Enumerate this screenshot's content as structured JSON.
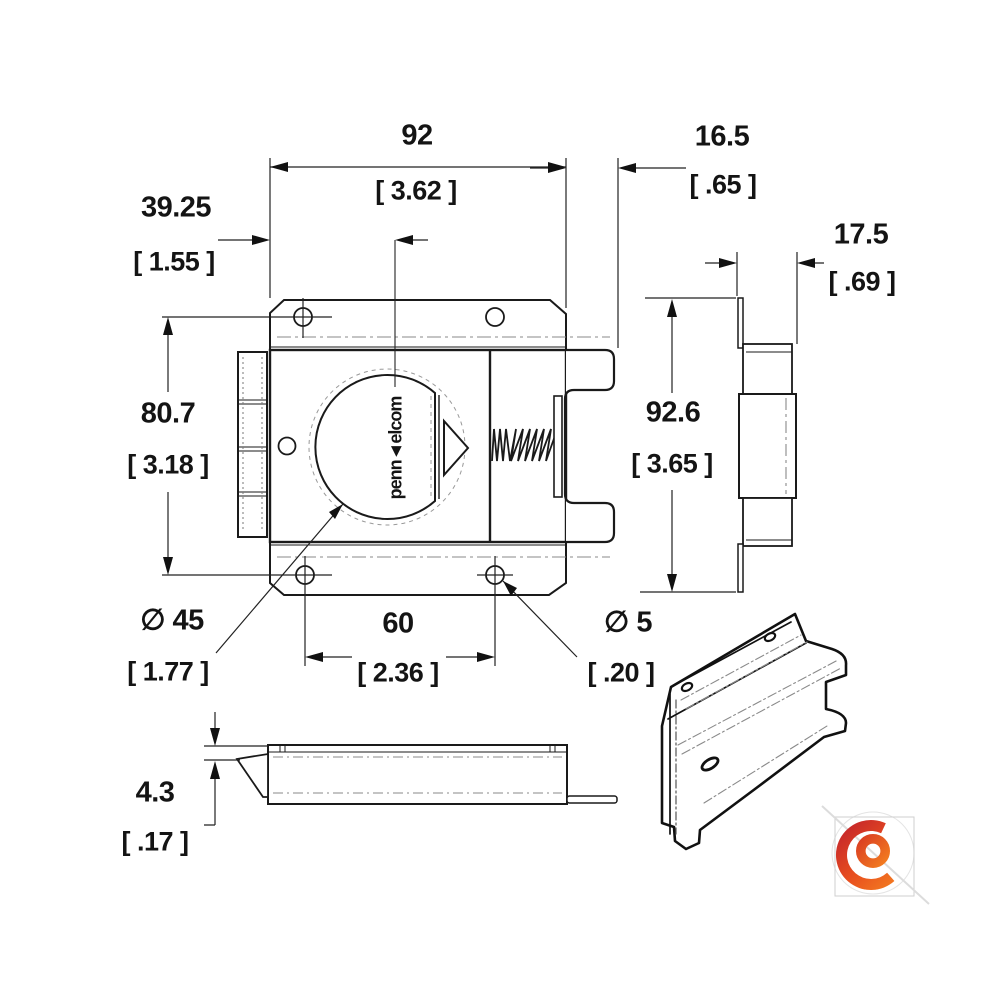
{
  "drawing": {
    "title": "latch-technical-drawing",
    "views": [
      "front",
      "side",
      "bottom",
      "isometric"
    ],
    "dial_label": "penn◄elcom",
    "dims": {
      "plate_width": {
        "mm": "92",
        "in": "[ 3.62 ]"
      },
      "bolt_extension": {
        "mm": "16.5",
        "in": "[ .65 ]"
      },
      "dial_offset": {
        "mm": "39.25",
        "in": "[ 1.55 ]"
      },
      "side_depth": {
        "mm": "17.5",
        "in": "[ .69 ]"
      },
      "hole_span_vertical": {
        "mm": "80.7",
        "in": "[ 3.18 ]"
      },
      "side_height": {
        "mm": "92.6",
        "in": "[ 3.65 ]"
      },
      "dial_diameter": {
        "mm": "∅ 45",
        "in": "[ 1.77 ]"
      },
      "hole_span_horizontal": {
        "mm": "60",
        "in": "[ 2.36 ]"
      },
      "hole_diameter": {
        "mm": "∅ 5",
        "in": "[ .20 ]"
      },
      "plate_thickness": {
        "mm": "4.3",
        "in": "[ .17 ]"
      }
    },
    "logo_colors": {
      "red": "#be1e2d",
      "mid": "#e84e1f",
      "orange": "#f58220",
      "mid2": "#d93b22"
    }
  }
}
